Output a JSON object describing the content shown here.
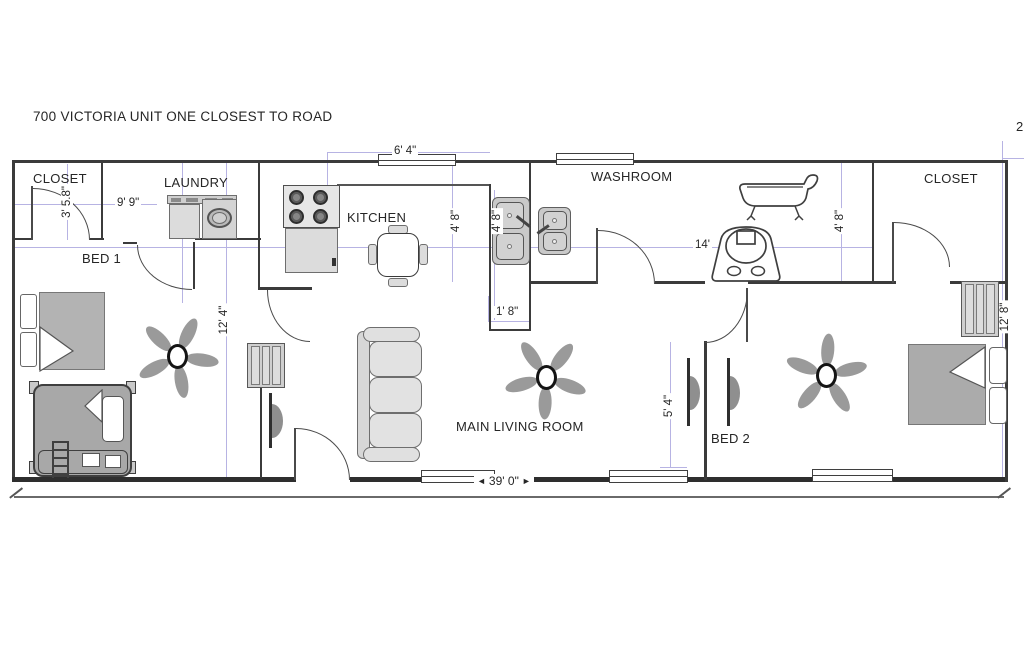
{
  "title": "700 VICTORIA UNIT ONE CLOSEST TO ROAD",
  "page_marker": "2",
  "rooms": {
    "closet_left": {
      "label": "CLOSET"
    },
    "laundry": {
      "label": "LAUNDRY"
    },
    "bed1": {
      "label": "BED 1"
    },
    "kitchen": {
      "label": "KITCHEN"
    },
    "washroom": {
      "label": "WASHROOM"
    },
    "closet_right": {
      "label": "CLOSET"
    },
    "living": {
      "label": "MAIN LIVING ROOM"
    },
    "bed2": {
      "label": "BED 2"
    }
  },
  "dimensions": {
    "closet_depth": "3' 5.8\"",
    "laundry_width": "9' 9\"",
    "kitchen_window": "6' 4\"",
    "kitchen_depth": "4' 8\"",
    "sink_counter": "4' 8\"",
    "washroom_depth": "4' 8\"",
    "counter_width": "1' 8\"",
    "washroom_width": "14'",
    "bed1_depth": "12' 4\"",
    "bed2_wall": "5' 4\"",
    "bed2_depth": "12' 8\"",
    "overall_width": "39' 0\""
  },
  "icons": {
    "dim_arrow_left": "◄",
    "dim_arrow_right": "►"
  },
  "colors": {
    "wall": "#3b3b3b",
    "dimension_line": "#b7b3e3",
    "furniture_fill": "#dcdcdc",
    "text": "#262626"
  }
}
